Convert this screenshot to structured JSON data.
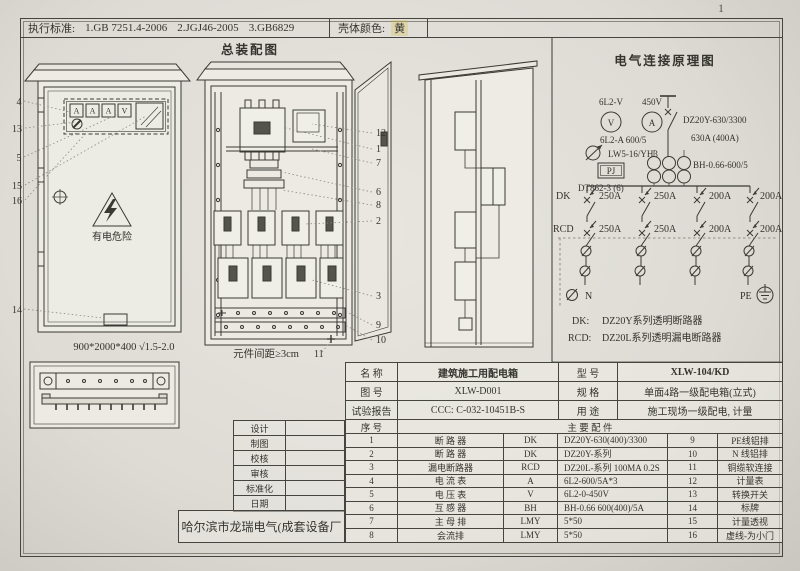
{
  "page_number": "1",
  "colors": {
    "paper": "#e6e4dd",
    "ink": "#3f3e3a",
    "shell_yellow": "#d8b92a"
  },
  "header": {
    "standards_label": "执行标准:",
    "standard_1": "1.GB 7251.4-2006",
    "standard_2": "2.JGJ46-2005",
    "standard_3": "3.GB6829",
    "shell_color_label": "壳体颜色:",
    "shell_color_value": "黄"
  },
  "titles": {
    "assembly": "总装配图",
    "schematic": "电气连接原理图"
  },
  "front_view": {
    "meters": [
      "A",
      "A",
      "A",
      "V"
    ],
    "warning": "有电危险",
    "dimension": "900*2000*400  √1.5-2.0",
    "callouts": [
      "4",
      "13",
      "5",
      "15",
      "16",
      "14"
    ]
  },
  "open_view": {
    "note": "元件间距≥3cm",
    "callouts": [
      "12",
      "1",
      "7",
      "6",
      "8",
      "2",
      "3",
      "9",
      "10"
    ],
    "callout_11": "11"
  },
  "schematic": {
    "pt_label": "6L2-V",
    "pt_voltage": "450V",
    "voltmeter": "V",
    "ammeter": "A",
    "ct_meter_label": "6L2-A 600/5",
    "selector_label": "LW5-16/YH3",
    "meter_box": "PJ",
    "kwh_label": "DT862-3 (6)",
    "main_breaker": "DZ20Y-630/3300",
    "main_rating": "630A (400A)",
    "ct_label": "BH-0.66-600/5",
    "dk": "DK",
    "rcd": "RCD",
    "dk_ratings": [
      "250A",
      "250A",
      "200A",
      "200A"
    ],
    "rcd_ratings": [
      "250A",
      "250A",
      "200A",
      "200A"
    ],
    "n": "N",
    "pe": "PE",
    "legend_dk_key": "DK:",
    "legend_dk": "DZ20Y系列透明断路器",
    "legend_rcd_key": "RCD:",
    "legend_rcd": "DZ20L系列透明漏电断路器"
  },
  "title_block": {
    "rows": [
      {
        "label": "名  称",
        "value": "建筑施工用配电箱",
        "label2": "型  号",
        "value2": "XLW-104/KD"
      },
      {
        "label": "图  号",
        "value": "XLW-D001",
        "label2": "规  格",
        "value2": "单面4路一级配电箱(立式)"
      },
      {
        "label": "试验报告",
        "value": "CCC: C-032-10451B-S",
        "label2": "用  途",
        "value2": "施工现场一级配电, 计量"
      }
    ],
    "seq_label": "序  号",
    "parts_header": "主  要  配  件",
    "parts": [
      {
        "no": "1",
        "name": "断 路 器",
        "code": "DK",
        "spec": "DZ20Y-630(400)/3300",
        "no2": "9",
        "name2": "PE线铝排"
      },
      {
        "no": "2",
        "name": "断 路 器",
        "code": "DK",
        "spec": "DZ20Y-系列",
        "no2": "10",
        "name2": "N 线铝排"
      },
      {
        "no": "3",
        "name": "漏电断路器",
        "code": "RCD",
        "spec": "DZ20L-系列  100MA 0.2S",
        "no2": "11",
        "name2": "铜缆软连接"
      },
      {
        "no": "4",
        "name": "电 流 表",
        "code": "A",
        "spec": "6L2-600/5A*3",
        "no2": "12",
        "name2": "计量表"
      },
      {
        "no": "5",
        "name": "电 压 表",
        "code": "V",
        "spec": "6L2-0-450V",
        "no2": "13",
        "name2": "转换开关"
      },
      {
        "no": "6",
        "name": "互 感 器",
        "code": "BH",
        "spec": "BH-0.66 600(400)/5A",
        "no2": "14",
        "name2": "标牌"
      },
      {
        "no": "7",
        "name": "主 母 排",
        "code": "LMY",
        "spec": "5*50",
        "no2": "15",
        "name2": "计量透视"
      },
      {
        "no": "8",
        "name": "会流排",
        "code": "LMY",
        "spec": "5*50",
        "no2": "16",
        "name2": "虚线-为小门"
      }
    ]
  },
  "sign_block": {
    "rows": [
      "设计",
      "制图",
      "校核",
      "审核",
      "标准化",
      "日期"
    ],
    "company": "哈尔滨市龙瑞电气(成套设备厂"
  }
}
